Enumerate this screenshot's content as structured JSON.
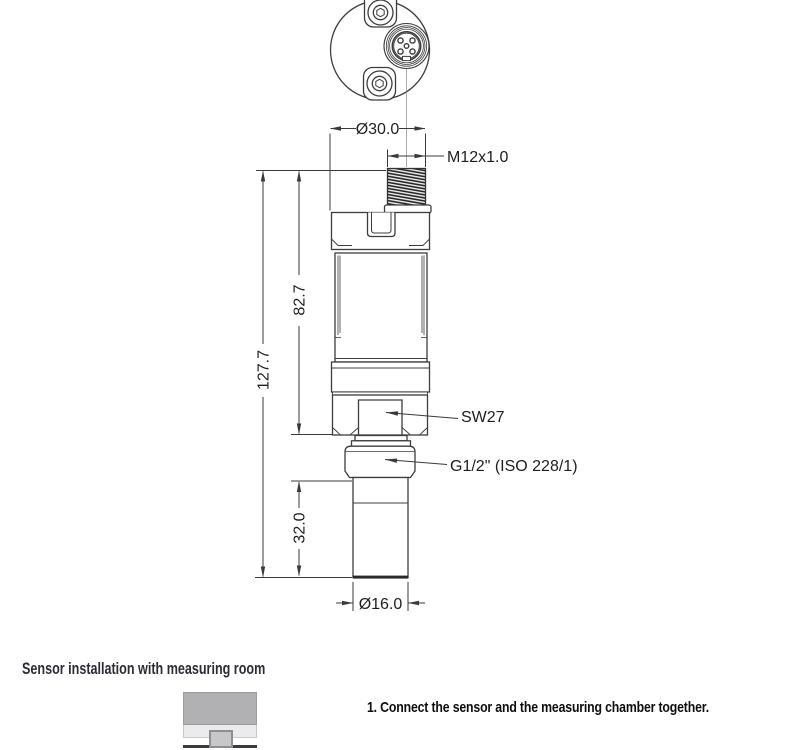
{
  "drawing": {
    "line_color": "#3d3d3d",
    "dim_color": "#3a3a3a",
    "labels": {
      "dia_body": "Ø30.0",
      "thread_connector": "M12x1.0",
      "len_body": "82.7",
      "len_overall": "127.7",
      "len_probe": "32.0",
      "dia_probe": "Ø16.0",
      "hex": "SW27",
      "thread_process": "G1/2\" (ISO 228/1)"
    }
  },
  "install": {
    "title": "Sensor installation with measuring room",
    "steps": [
      "1. Connect the sensor and the measuring chamber together."
    ]
  }
}
